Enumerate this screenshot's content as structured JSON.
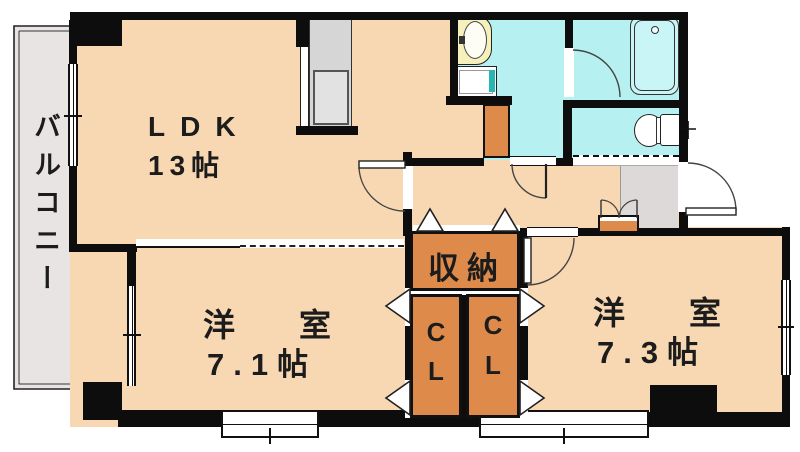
{
  "floorplan": {
    "balcony": {
      "label": "バルコニー"
    },
    "ldk": {
      "name": "LDK",
      "size": "13帖"
    },
    "room71": {
      "name": "洋室",
      "size": "7.1帖"
    },
    "room73": {
      "name": "洋室",
      "size": "7.3帖"
    },
    "storage": {
      "label": "収納"
    },
    "closet_left": {
      "line1": "C",
      "line2": "L"
    },
    "closet_right": {
      "line1": "C",
      "line2": "L"
    },
    "fixtures": {
      "kitchen": "kitchen-counter",
      "washbasin": "wash-basin",
      "washer": "washing-machine-pan",
      "bathtub": "bathtub",
      "toilet": "toilet",
      "shoe_cabinet": "shoe-cabinet"
    },
    "colors": {
      "floor": "#f8d8b2",
      "closet_orange": "#de8a4a",
      "wet_area": "#b6f0f1",
      "bathtub_fill": "#c9f5f6",
      "balcony_gray": "#e8e4e4",
      "entrance_gray": "#ddd9d9",
      "wall": "#0d0d0d",
      "kitchen_gray": "#d6d6d6",
      "sink_cream": "#f5f0bc"
    }
  }
}
